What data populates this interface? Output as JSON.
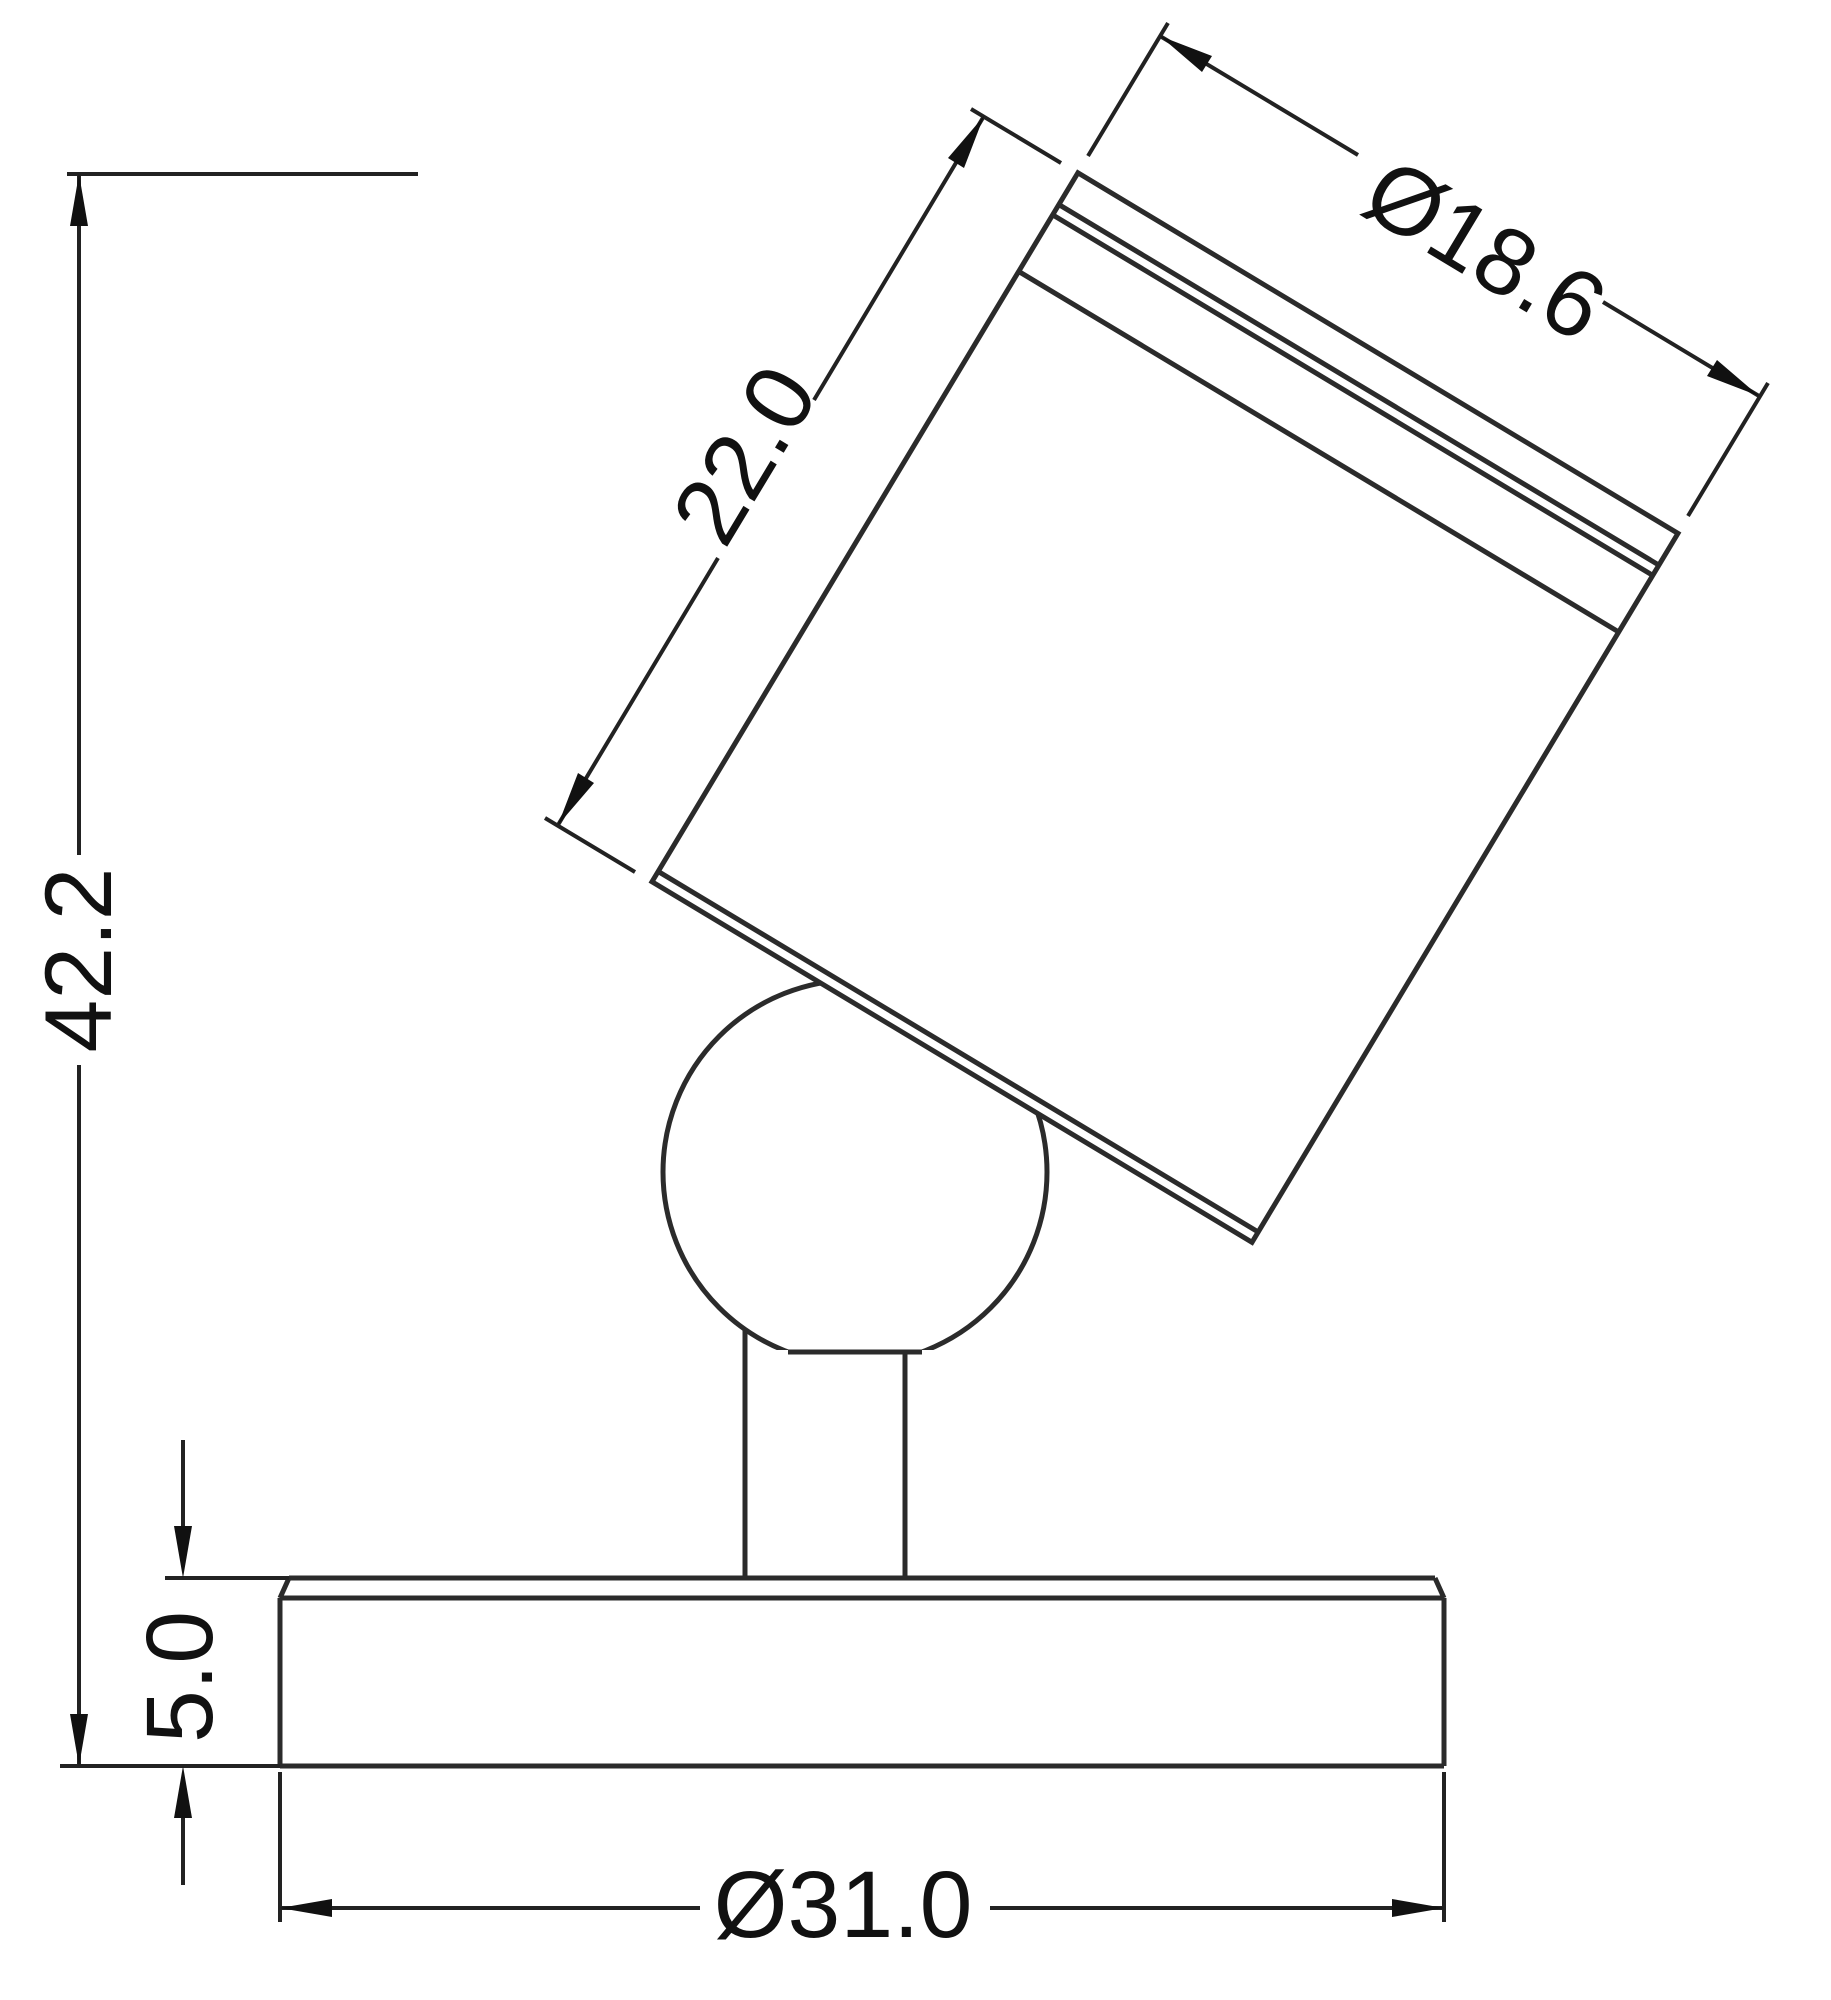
{
  "drawing": {
    "background_color": "#ffffff",
    "line_color": "#2b2b2b",
    "dimension_color": "#111111",
    "dimensions": {
      "head_length": {
        "label": "22.0",
        "value": 22.0
      },
      "head_diameter": {
        "label": "Ø18.6",
        "value": 18.6
      },
      "overall_height": {
        "label": "42.2",
        "value": 42.2
      },
      "base_thickness": {
        "label": "5.0",
        "value": 5.0
      },
      "base_diameter": {
        "label": "Ø31.0",
        "value": 31.0
      }
    }
  }
}
